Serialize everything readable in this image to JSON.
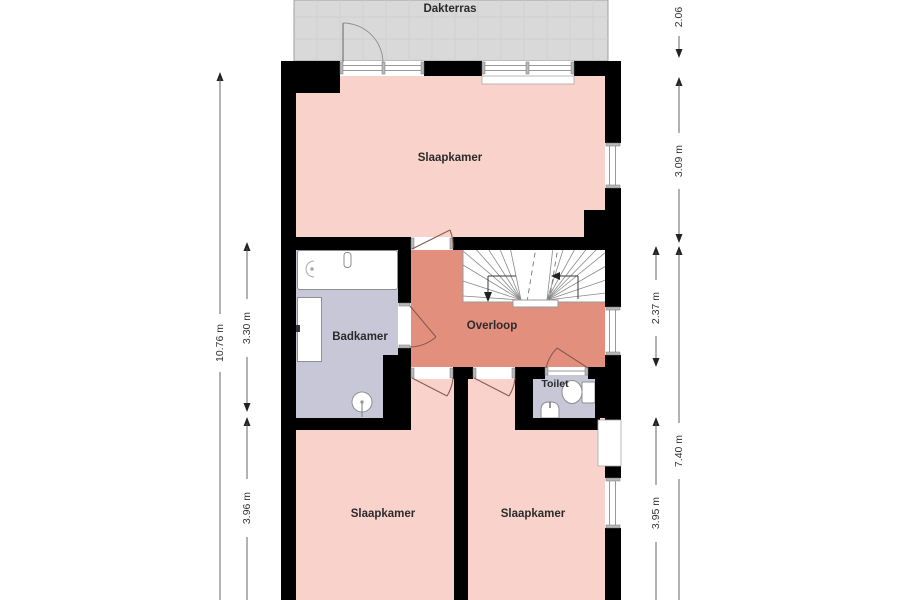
{
  "floorplan": {
    "labels": {
      "dakterras": "Dakterras",
      "slaapkamer_top": "Slaapkamer",
      "badkamer": "Badkamer",
      "overloop": "Overloop",
      "toilet": "Toilet",
      "slaapkamer_left": "Slaapkamer",
      "slaapkamer_right": "Slaapkamer"
    },
    "dimensions": {
      "total_height_left": "10.76 m",
      "badkamer_height": "3.30 m",
      "slaapkamer_left_height": "3.96 m",
      "terrace_height": "2.06",
      "slaapkamer_top_height": "3.09 m",
      "overloop_height": "2.37 m",
      "lower_section_height": "7.40 m",
      "slaapkamer_right_height": "3.95 m"
    },
    "colors": {
      "wall": "#000000",
      "bedroom": "#f9d3cb",
      "overloop": "#e28f7e",
      "wetroom": "#c7c7d8",
      "terrace": "#d9d9d9",
      "door_swing": "#8a5a50",
      "dimension_text": "#333333"
    }
  }
}
